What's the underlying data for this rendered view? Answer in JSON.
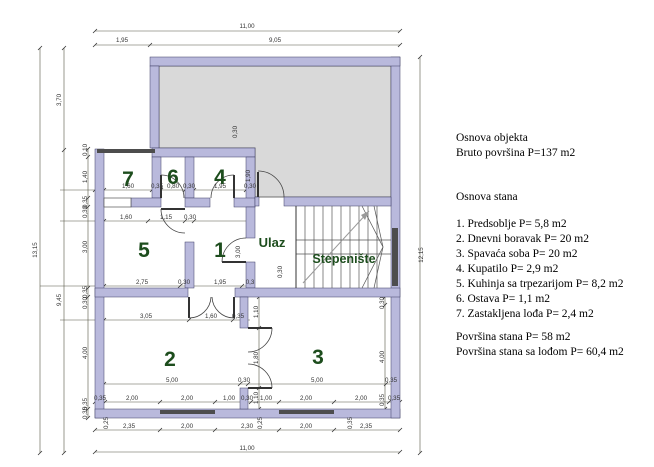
{
  "legend": {
    "title": "Osnova objekta",
    "gross": "Bruto površina P=137 m2",
    "section": "Osnova stana",
    "items": [
      "1. Predsoblje P= 5,8 m2",
      "2. Dnevni boravak P= 20 m2",
      "3. Spavaća soba P= 20 m2",
      "4. Kupatilo P= 2,9 m2",
      "5. Kuhinja sa trpezarijom P= 8,2 m2",
      "6. Ostava P= 1,1 m2",
      "7. Zastakljena lođa P= 2,4 m2"
    ],
    "net": "Površina stana P= 58 m2",
    "net_with_loggia": "Površina stana sa lođom P= 60,4 m2"
  },
  "plan": {
    "rooms": {
      "n1": "1",
      "n2": "2",
      "n3": "3",
      "n4": "4",
      "n5": "5",
      "n6": "6",
      "n7": "7"
    },
    "labels": {
      "entrance": "Ulaz",
      "staircase": "Stepenište"
    },
    "colors": {
      "wall": "#b9b9dc",
      "terrace_fill": "#d9d9d9",
      "room_number": "#1d4d1d",
      "dimension_line": "#555544",
      "window": "#4d4d4d",
      "background": "#ffffff"
    },
    "dims": {
      "top_total": "11,00",
      "top_sub": [
        "1,95",
        "9,05"
      ],
      "left_total": "13,15",
      "left_sub": [
        "3,70",
        "9,45"
      ],
      "right_total": "12,15",
      "row_loggia": [
        "1,60",
        "0,35",
        "0,80",
        "0,30",
        "1,95",
        "0,30"
      ],
      "v_terrace": "0,30",
      "v_room4": "1,90",
      "row_kitchen": [
        "1,60",
        "1,15",
        "0,30"
      ],
      "left_chain": [
        "0,10",
        "1,40",
        "0,35",
        "0,30",
        "3,00",
        "0,35",
        "0,30",
        "4,00",
        "0,35",
        "0,35"
      ],
      "v_room1": "3,00",
      "v_stair": "0,30",
      "row_mid": [
        "2,75",
        "0,30",
        "1,95",
        "0,3"
      ],
      "row_room2_top": [
        "3,05",
        "1,60",
        "0,35"
      ],
      "corridor_chain": [
        "1,10",
        "1,80",
        "1,10"
      ],
      "right_chain": [
        "0,30",
        "4,00",
        "0,35"
      ],
      "row_rooms23": [
        "5,00",
        "0,30",
        "5,00",
        "0,35"
      ],
      "bottom_row1": [
        "0,35",
        "2,00",
        "2,00",
        "1,00",
        "0,30",
        "1,00",
        "2,00",
        "2,00",
        "0,35"
      ],
      "bottom_row2": [
        "2,35",
        "2,00",
        "2,30",
        "2,00",
        "2,35"
      ],
      "bottom_total": "11,00",
      "bottom_small": [
        "0,25",
        "0,25",
        "0,35"
      ]
    }
  }
}
